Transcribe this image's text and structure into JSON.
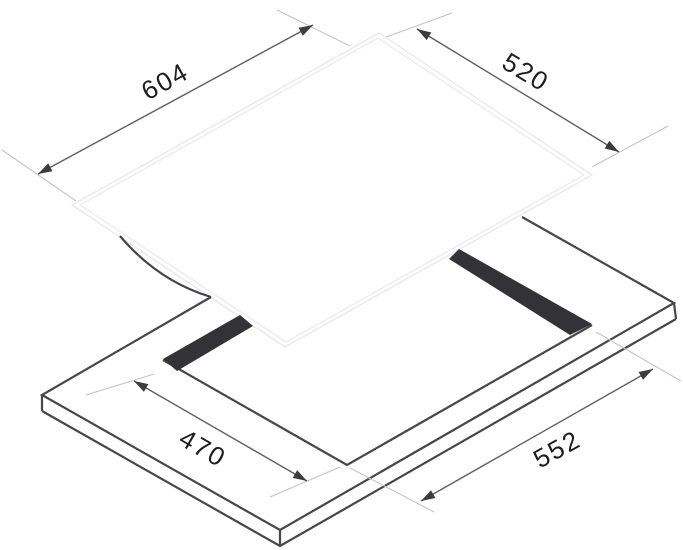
{
  "diagram": {
    "type": "technical-drawing",
    "subject": "Built-in hob installation diagram with glass top and worktop cutout, isometric exploded view",
    "dimensions": {
      "glass_width": "604",
      "glass_depth": "520",
      "cutout_depth": "470",
      "cutout_width": "552"
    },
    "colors": {
      "background": "#ffffff",
      "worktop_outline": "#47474b",
      "cutout_gap_fill": "#333337",
      "glass_outline": "#e9e9eb",
      "dimension_line": "#5f5f63",
      "extension_line": "#c4c4c8",
      "arrowhead": "#3c3c40",
      "label_text": "#1e1e1e"
    }
  }
}
